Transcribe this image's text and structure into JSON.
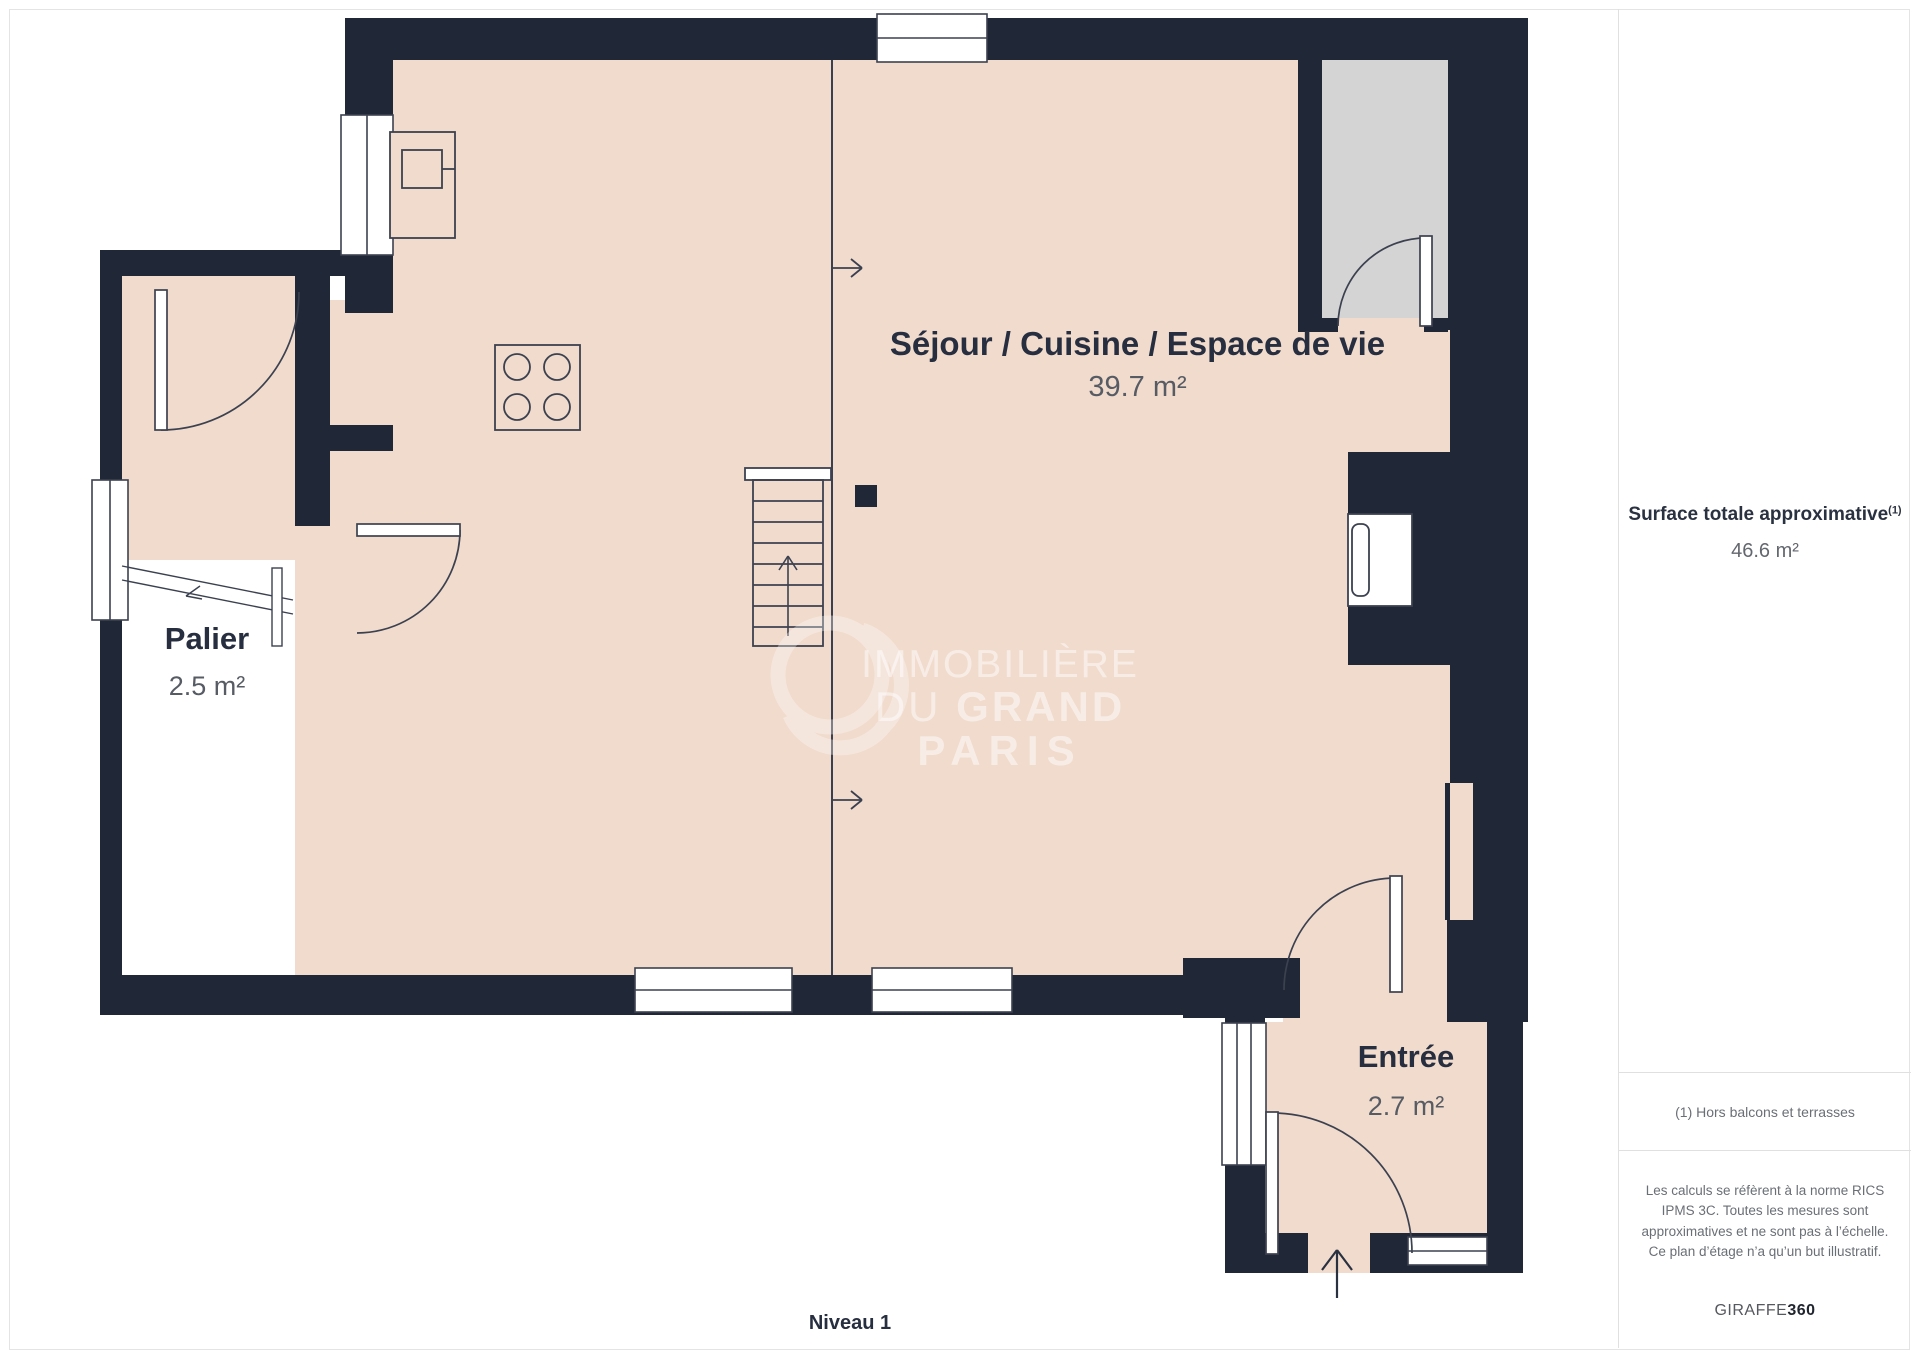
{
  "plan": {
    "level_label": "Niveau 1",
    "rooms": {
      "sejour": {
        "name": "Séjour / Cuisine / Espace de vie",
        "area": "39.7 m²"
      },
      "palier": {
        "name": "Palier",
        "area": "2.5 m²"
      },
      "entree": {
        "name": "Entrée",
        "area": "2.7 m²"
      }
    },
    "watermark": {
      "line1": "IMMOBILIÈRE",
      "line2_light": "DU",
      "line2_bold": "GRAND",
      "line3": "PARIS"
    }
  },
  "sidebar": {
    "surface_label": "Surface totale approximative",
    "surface_superscript": "(1)",
    "surface_value": "46.6 m²",
    "footnote": "(1) Hors balcons et terrasses",
    "disclaimer": "Les calculs se réfèrent à la norme RICS IPMS 3C. Toutes les mesures sont approximatives et ne sont pas à l’échelle. Ce plan d’étage n’a qu’un but illustratif.",
    "brand": {
      "name": "GIRAFFE",
      "suffix": "360"
    }
  },
  "colors": {
    "wall": "#202736",
    "floor": "#f1dbcd",
    "closet": "#d4d4d4",
    "stroke": "#3c4150",
    "text_navy": "#262e3f",
    "text_gray": "#565b64",
    "divider": "#e0e0e0"
  }
}
